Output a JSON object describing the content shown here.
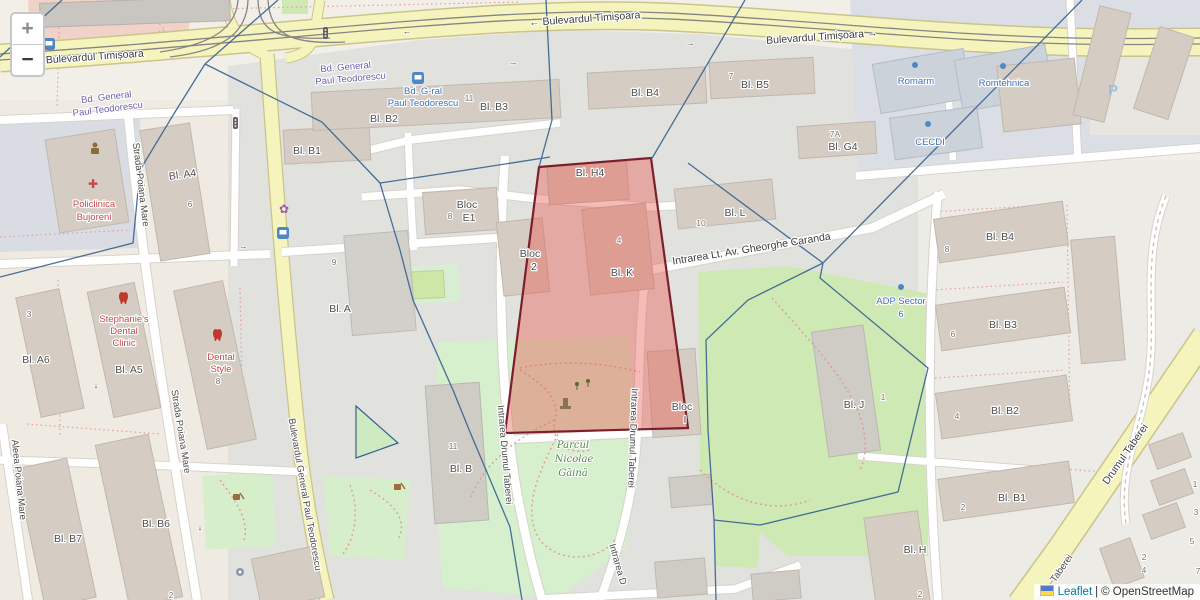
{
  "controls": {
    "zoom_in": "+",
    "zoom_out": "−"
  },
  "attribution": {
    "leaflet": "Leaflet",
    "separator": "|",
    "copyright": "© OpenStreetMap"
  },
  "colors": {
    "selection_fill": "#e9544a",
    "selection_border": "#7a1f2b",
    "boundary_blue": "#35618e",
    "road_primary_yellow": "#f6f4bd",
    "link_blue": "#0078a8"
  },
  "streets": {
    "timisoara_left": "Bulevardul Timișoara",
    "timisoara_center": "← Bulevardul Timișoara",
    "timisoara_right": "Bulevardul Timișoara →",
    "bd_general_left_1": "Bd. General",
    "bd_general_left_2": "Paul Teodorescu",
    "bd_general_center_1": "Bd. General",
    "bd_general_center_2": "Paul Teodorescu",
    "strada_poiana_mare_1": "Strada Poiana Mare",
    "strada_poiana_mare_2": "Strada Poiana Mare",
    "aleea_poiana_mare": "Aleea Poiana Mare",
    "bd_general_vertical": "Bulevardul General Paul Teodorescu",
    "intrarea_drumul_taberei_1": "Intrarea Drumul Taberei",
    "intrarea_drumul_taberei_2": "Intrarea Drumul Taberei",
    "intrarea_d_cut": "Intrarea D",
    "caranda": "Intrarea Lt. Av. Gheorghe Caranda",
    "drumul_taberei": "Drumul Taberei",
    "taberei_cut": "Taberei"
  },
  "transit": {
    "stop_name_1": "Bd. G-ral",
    "stop_name_2": "Paul Teodorescu"
  },
  "pois": {
    "policlinica_1": "Policlinica",
    "policlinica_2": "Bujoreni",
    "stephanies_1": "Stephanie's",
    "stephanies_2": "Dental",
    "stephanies_3": "Clinic",
    "dental_style_1": "Dental",
    "dental_style_2": "Style",
    "park_1": "Parcul",
    "park_2": "Nicolae",
    "park_3": "Găină",
    "adp_1": "ADP Sector",
    "adp_2": "6",
    "romarm": "Romarm",
    "romtehnica": "Romtehnica",
    "cecdi": "CECDI",
    "parking": "P"
  },
  "buildings": {
    "bl_b1_nw": "Bl. B1",
    "bl_b2_n": "Bl. B2",
    "bl_b3_n": "Bl. B3",
    "bl_b4_n": "Bl. B4",
    "bl_b5_n": "Bl. B5",
    "bl_g4": "Bl. G4",
    "bl_a4": "Bl. A4",
    "bl_a6": "Bl. A6",
    "bl_a5": "Bl. A5",
    "bl_b7": "Bl. B7",
    "bl_b6": "Bl. B6",
    "bl_a": "Bl. A",
    "bloc_e1_1": "Bloc",
    "bloc_e1_2": "E1",
    "bloc_2_1": "Bloc",
    "bloc_2_2": "2",
    "bl_h4": "Bl. H4",
    "bl_k": "Bl. K",
    "bl_l": "Bl. L",
    "bloc_i_1": "Bloc",
    "bloc_i_2": "I",
    "bl_b_c": "Bl. B",
    "bl_j": "Bl. J",
    "bl_b4_e": "Bl. B4",
    "bl_b3_e": "Bl. B3",
    "bl_b2_e": "Bl. B2",
    "bl_b1_e": "Bl. B1",
    "bl_h_e": "Bl. H"
  },
  "numbers": {
    "n11_top": "11",
    "n7": "7",
    "n7a": "7A",
    "n6_a4": "6",
    "n3": "3",
    "n8_dental": "8",
    "n2_sw": "2",
    "n9": "9",
    "n8_e1": "8",
    "n4_k": "4",
    "n10": "10",
    "n11_b": "11",
    "n1_j": "1",
    "n8_e": "8",
    "n6_e": "6",
    "n4_e": "4",
    "n2_b1": "2",
    "n2_h": "2",
    "h1": "1",
    "h3": "3",
    "h5": "5",
    "h7": "7",
    "h2": "2",
    "h4": "4"
  },
  "icons": {
    "arrow_left": "←",
    "arrow_right": "→",
    "arrow_down": "↓",
    "cross": "✚",
    "flower": "✿"
  }
}
